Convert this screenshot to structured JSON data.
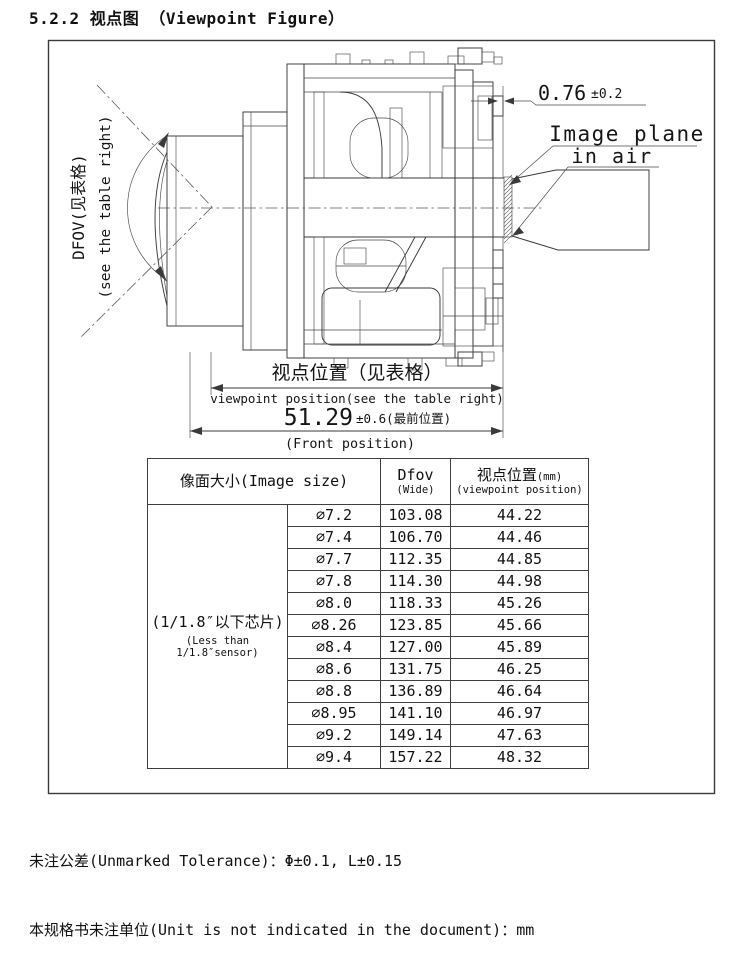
{
  "title": "5.2.2 视点图 （Viewpoint Figure）",
  "figure": {
    "dfov_label_cn": "DFOV(见表格)",
    "dfov_label_en": "(see the table right)",
    "gap_dimension": "0.76",
    "gap_tolerance": "±0.2",
    "image_plane_line1": "Image plane",
    "image_plane_line2": "in air",
    "viewpoint_dim_cn": "视点位置（见表格）",
    "viewpoint_dim_en": "viewpoint position(see the table right)",
    "front_dim_value": "51.29",
    "front_dim_suffix": "±0.6(最前位置)",
    "front_dim_en": "(Front position)"
  },
  "table": {
    "header_image_size": "像面大小(Image size)",
    "header_dfov_line1": "Dfov",
    "header_dfov_line2": "(Wide)",
    "header_viewpoint_line1": "视点位置",
    "header_viewpoint_mm": "(mm)",
    "header_viewpoint_line2": "(viewpoint position)",
    "sensor_group_line1": "(1/1.8″以下芯片)",
    "sensor_group_line2": "(Less than 1/1.8″sensor)",
    "rows": [
      {
        "size": "∅7.2",
        "dfov": "103.08",
        "viewpoint": "44.22"
      },
      {
        "size": "∅7.4",
        "dfov": "106.70",
        "viewpoint": "44.46"
      },
      {
        "size": "∅7.7",
        "dfov": "112.35",
        "viewpoint": "44.85"
      },
      {
        "size": "∅7.8",
        "dfov": "114.30",
        "viewpoint": "44.98"
      },
      {
        "size": "∅8.0",
        "dfov": "118.33",
        "viewpoint": "45.26"
      },
      {
        "size": "∅8.26",
        "dfov": "123.85",
        "viewpoint": "45.66"
      },
      {
        "size": "∅8.4",
        "dfov": "127.00",
        "viewpoint": "45.89"
      },
      {
        "size": "∅8.6",
        "dfov": "131.75",
        "viewpoint": "46.25"
      },
      {
        "size": "∅8.8",
        "dfov": "136.89",
        "viewpoint": "46.64"
      },
      {
        "size": "∅8.95",
        "dfov": "141.10",
        "viewpoint": "46.97"
      },
      {
        "size": "∅9.2",
        "dfov": "149.14",
        "viewpoint": "47.63"
      },
      {
        "size": "∅9.4",
        "dfov": "157.22",
        "viewpoint": "48.32"
      }
    ]
  },
  "notes": {
    "tolerance": "未注公差(Unmarked Tolerance)：Φ±0.1, L±0.15",
    "unit": "本规格书未注单位(Unit is not indicated in the document)：mm"
  },
  "colors": {
    "line": "#3a3a3a",
    "text": "#111111",
    "background": "#ffffff"
  }
}
